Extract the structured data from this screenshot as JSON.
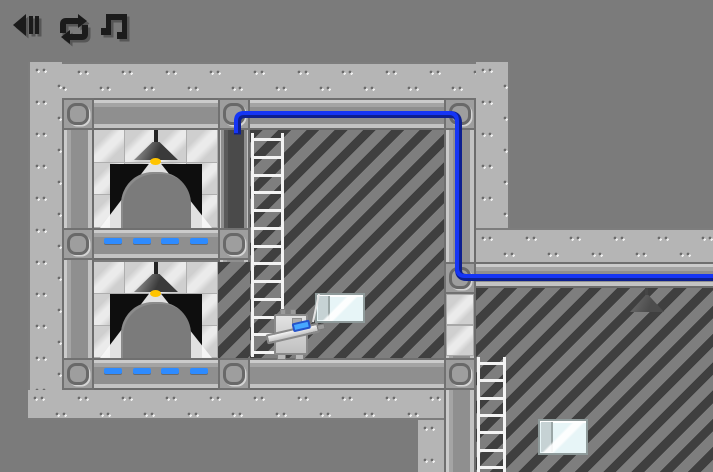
{
  "app": {
    "name": "robot-puzzle-platformer",
    "scene": "industrial-elevator-level",
    "background_color": "#7b7b7b"
  },
  "toolbar": {
    "buttons": [
      {
        "id": "back",
        "icon": "back-icon"
      },
      {
        "id": "restart",
        "icon": "restart-icon"
      },
      {
        "id": "music",
        "icon": "music-note-icon"
      }
    ]
  },
  "colors": {
    "background": "#7b7b7b",
    "wall": "#b5b5b5",
    "beam": "#8f8f8f",
    "beam_dark": "#6e6e6e",
    "beam_light": "#cbcbcb",
    "stripe_dark": "#3f3f3f",
    "stripe_light": "#7e7e7e",
    "tile": "#cfcfcf",
    "tile_shine": "#ebebeb",
    "wire": "#1535f5",
    "wire_shadow": "#0d1f8f",
    "dash": "#2e8bff",
    "lamp_bulb": "#ffc400",
    "ladder": "#f3f3f3",
    "shaft": "#4a4a4a",
    "door_opening": "#0e0e0e",
    "arch": "#7b7b7b",
    "crate_face": "#e7f5f7",
    "crate_trim": "#c6d2d4",
    "robot_body": "#c9c9c9",
    "robot_visor": "#47a8ff",
    "icon": "#1b1b1b",
    "icon_shadow": "#565656"
  },
  "level": {
    "rooms": [
      {
        "id": "elevator-room-top",
        "lamp_lit": true,
        "elevator_door": true
      },
      {
        "id": "elevator-room-bottom",
        "lamp_lit": true,
        "elevator_door": true
      },
      {
        "id": "shaft-room",
        "hazard_stripes": true
      },
      {
        "id": "right-room",
        "hazard_stripes": true,
        "lamp_silhouette": true
      }
    ],
    "dash_rows": [
      {
        "count": 4
      },
      {
        "count": 4
      }
    ],
    "ladders": [
      {
        "id": "shaft-ladder",
        "rungs": 13
      },
      {
        "id": "right-ladder",
        "rungs": 7
      }
    ],
    "wire": {
      "present": true,
      "color": "#1535f5"
    },
    "entities": {
      "player_robot": {
        "holding": "gravity-gun",
        "facing": "right"
      },
      "carried_crate": {
        "state": "lifted"
      },
      "floor_crate": {
        "state": "resting"
      }
    }
  }
}
